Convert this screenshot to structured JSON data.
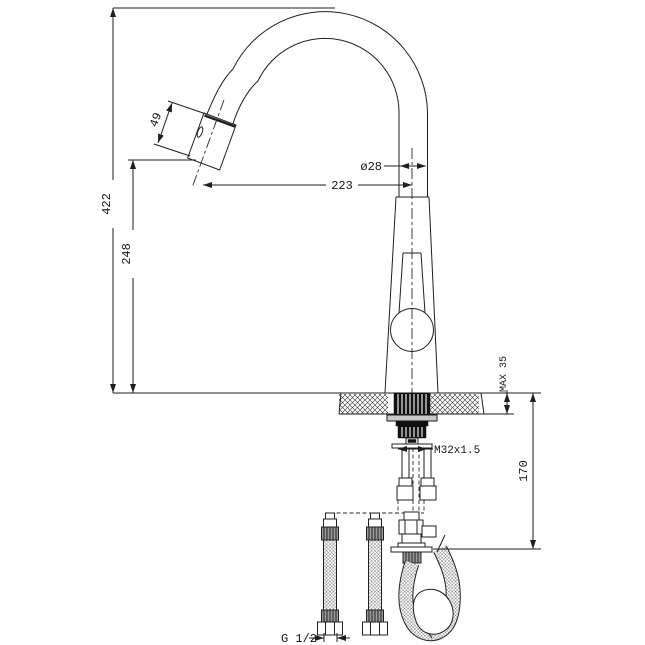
{
  "drawing": {
    "subject": "Pull-out kitchen mixer tap installation dimension drawing",
    "dimensions": {
      "overall_height": "422",
      "height_to_spout_outlet": "248",
      "spout_reach": "223",
      "spray_head_length": "49",
      "spout_tube_diameter": "ø28",
      "max_countertop_thickness": "MAX 35",
      "shank_thread": "M32x1.5",
      "under_counter_depth": "170",
      "supply_hose_thread": "G 1/2"
    }
  }
}
